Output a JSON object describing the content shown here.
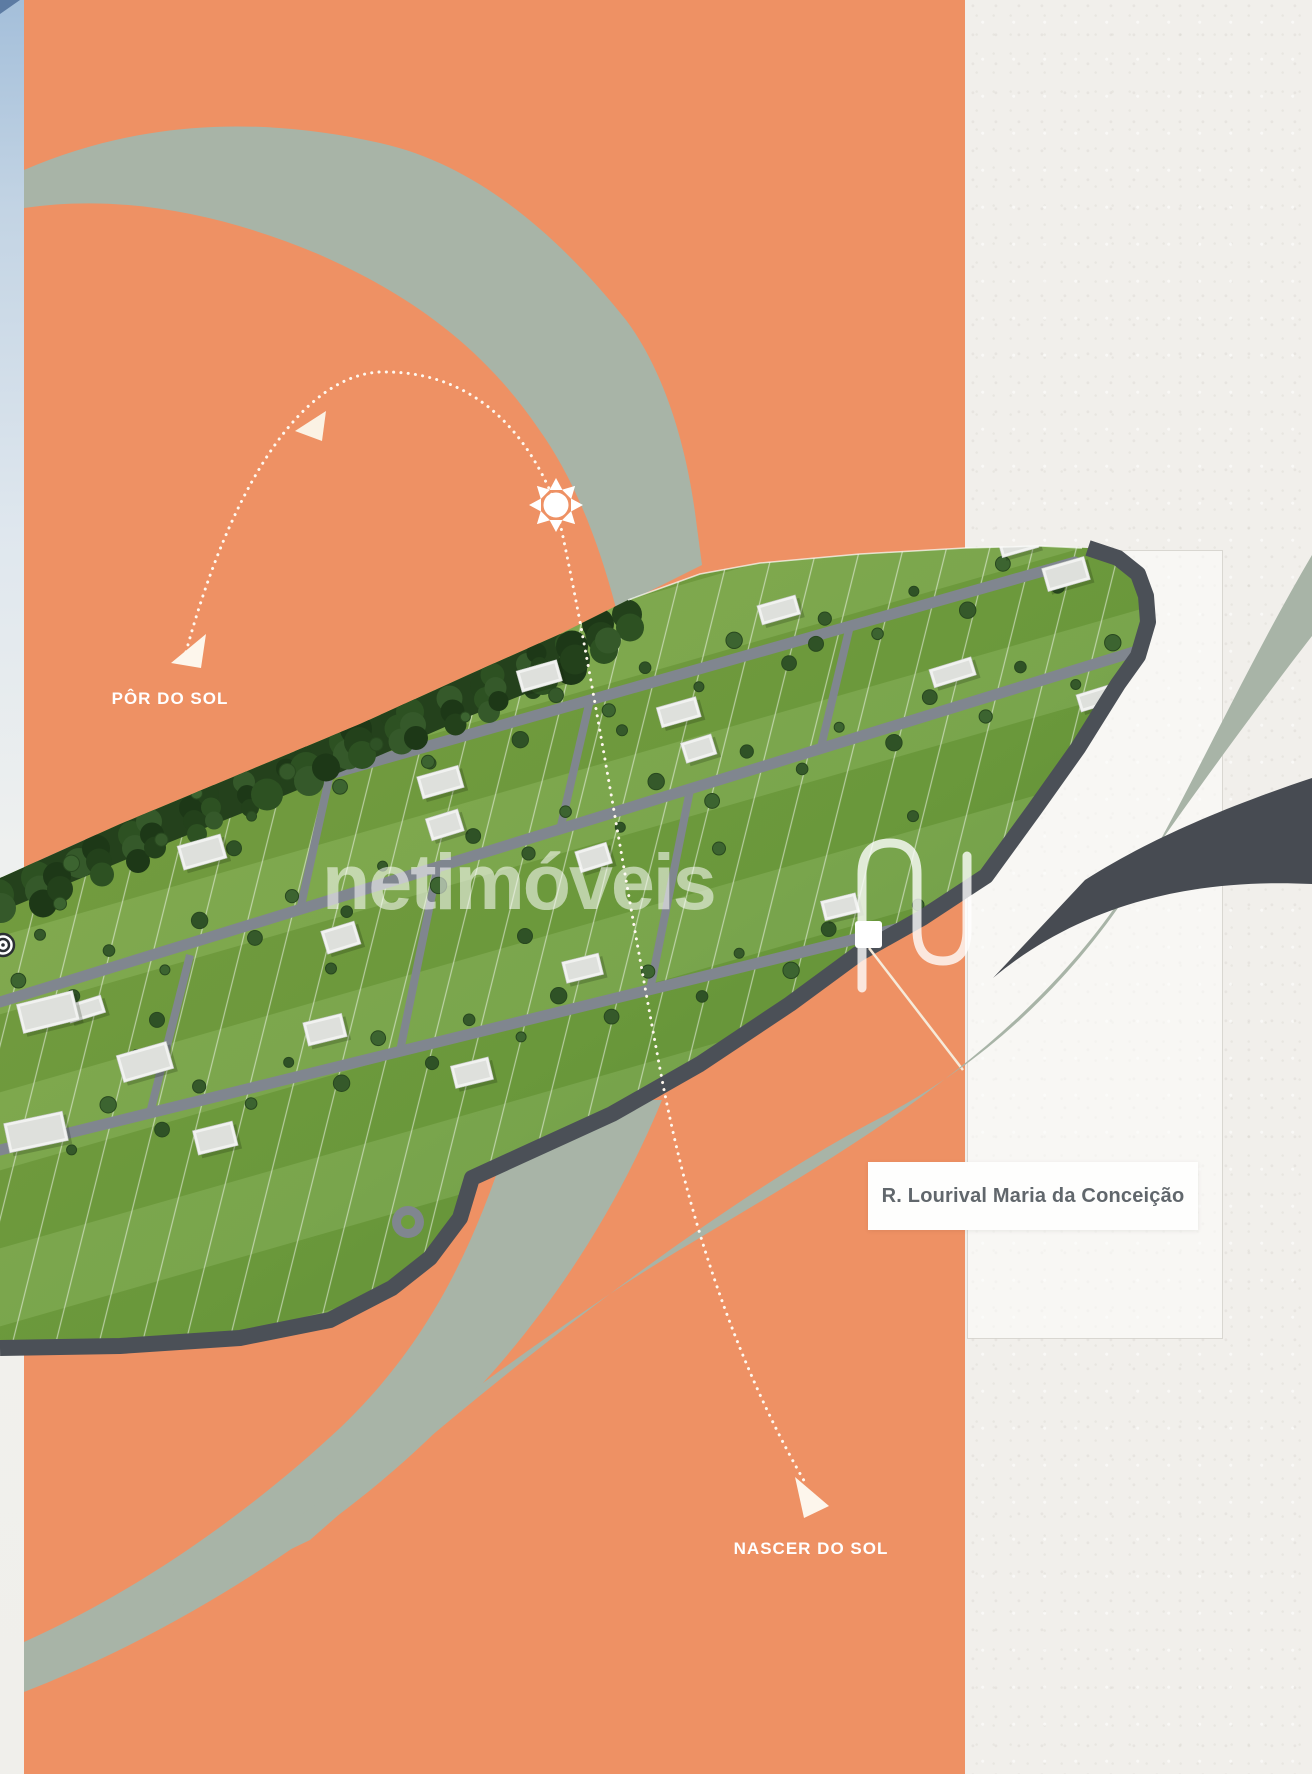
{
  "artwork": {
    "type": "real-estate-development-masterplan-collage",
    "labels": {
      "sunset": "PÔR DO SOL",
      "sunrise": "NASCER DO SOL",
      "street": "R. Lourival Maria da Conceição"
    },
    "watermark": {
      "text": "netimóveis",
      "logo": "netimoveis-n-monogram"
    },
    "icons": {
      "sun": "sun-icon",
      "sunset_arrow": "arrow-head-icon",
      "sunrise_arrow": "arrow-head-icon",
      "compass": "compass-target-icon",
      "marker": "street-marker-square"
    },
    "palette": {
      "orange": "#ee9164",
      "sage": "#a8b4a7",
      "paper": "#f1efeb",
      "dark_ribbon": "#474b52",
      "grass": "#75a140",
      "forest": "#2b4722",
      "road": "#80868f",
      "house": "#f1f2f0",
      "label_text": "#61676c",
      "dotted_line": "#fff8ef"
    }
  }
}
